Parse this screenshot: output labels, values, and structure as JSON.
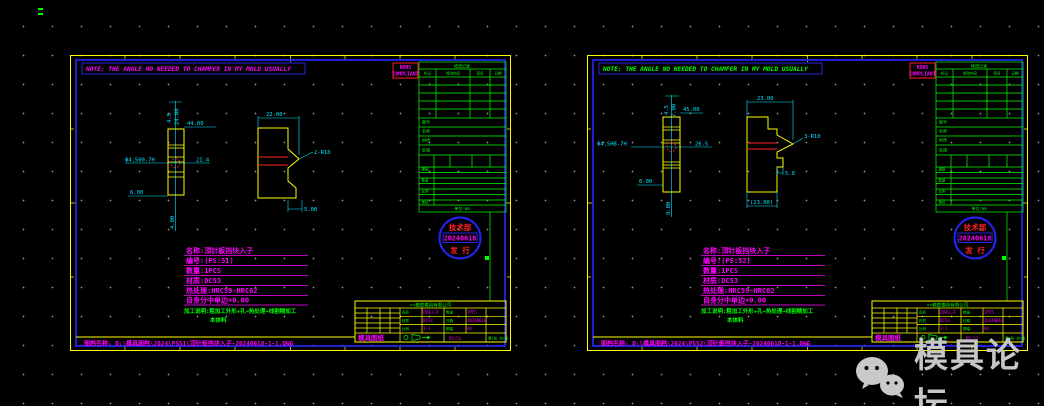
{
  "watermark": {
    "text": "模具论坛"
  },
  "sheets": [
    {
      "banner": "NOTE: THE ANGLE NO NEEDED TO CHAMFER IN MY MOLD USUALLY",
      "rohs_line1": "ROHS",
      "rohs_line2": "COMPLIANT",
      "front": {
        "dim_top_a": "4.5",
        "dim_top_b": "24.00",
        "dim_width": "44.00",
        "dim_mid": "21.4",
        "hole": "Φ4.500-7H",
        "dim_bottom": "6.00",
        "dim_bottom_v": "4.00"
      },
      "side": {
        "dim_top": "22.00",
        "radius": "2-R10",
        "dim_bottom": "5.00"
      },
      "specs": [
        "名称:顶针板挡块入子",
        "编号:(PS:51)",
        "数量:1PCS",
        "材质:DC53",
        "热处理:HRC59~HRC62",
        "自身分中单边+0.00"
      ],
      "process_note": "加工说明:粗加工外形+孔→热处理→线割精加工",
      "process_note2": "本体料",
      "stamp": {
        "top": "技术部",
        "date": "20240618",
        "bottom": "发 行"
      },
      "rev_table": {
        "title": "修改记录",
        "headers": [
          "标记",
          "修改内容",
          "签名",
          "日期"
        ],
        "labels": [
          "图号",
          "名称",
          "材质",
          "处理",
          "硬度",
          "数量",
          "比例",
          "单位"
        ],
        "unit": "单位:mm"
      },
      "title_block": {
        "company": "××精密模具有限公司",
        "fields": [
          {
            "label": "品名",
            "value": "挡块入子"
          },
          {
            "label": "数量",
            "value": "1PCS"
          },
          {
            "label": "材质",
            "value": "DC53"
          },
          {
            "label": "日期",
            "value": "20240618"
          },
          {
            "label": "比例",
            "value": "1:1"
          },
          {
            "label": "图幅",
            "value": "A4"
          }
        ],
        "doc_type": "模具图纸",
        "drawing_no": "PS:51",
        "page": "第1张 共1张"
      },
      "footer": "图档名称: D:\\模具图档\\2024\\PS51\\顶针板挡块入子-20240618-1-1.DWG"
    },
    {
      "banner": "NOTE: THE ANGLE NO NEEDED TO CHAMFER IN MY MOLD USUALLY",
      "rohs_line1": "ROHS",
      "rohs_line2": "COMPLIANT",
      "front": {
        "dim_top_a": "4.5",
        "dim_top_b": "7.00",
        "dim_width": "45.00",
        "dim_mid": "26.5",
        "hole": "Φ4.5H8-7H",
        "dim_bottom": "6.00",
        "dim_bottom_v": "9.00"
      },
      "side": {
        "dim_top": "23.00",
        "radius": "3-R10",
        "dim_bottom": "5.0",
        "dim_bottom2": "(23.00)"
      },
      "specs": [
        "名称:顶针板挡块入子",
        "编号:(PS:52)",
        "数量:1PCS",
        "材质:DC53",
        "热处理:HRC59~HRC62",
        "自身分中单边+0.00"
      ],
      "process_note": "加工说明:粗加工外形+孔→热处理→线割精加工",
      "process_note2": "本体料",
      "stamp": {
        "top": "技术部",
        "date": "20240618",
        "bottom": "发 行"
      },
      "rev_table": {
        "title": "修改记录",
        "headers": [
          "标记",
          "修改内容",
          "签名",
          "日期"
        ],
        "labels": [
          "图号",
          "名称",
          "材质",
          "处理",
          "硬度",
          "数量",
          "比例",
          "单位"
        ],
        "unit": "单位:mm"
      },
      "title_block": {
        "company": "××精密模具有限公司",
        "fields": [
          {
            "label": "品名",
            "value": "挡块入子"
          },
          {
            "label": "数量",
            "value": "1PCS"
          },
          {
            "label": "材质",
            "value": "DC53"
          },
          {
            "label": "日期",
            "value": "20240618"
          },
          {
            "label": "比例",
            "value": "1:1"
          },
          {
            "label": "图幅",
            "value": "A4"
          }
        ],
        "doc_type": "模具图纸",
        "drawing_no": "PS:52",
        "page": "第1张 共1张"
      },
      "footer": "图档名称: D:\\模具图档\\2024\\PS52\\顶针板挡块入子-20240618-1-1.DWG"
    }
  ]
}
